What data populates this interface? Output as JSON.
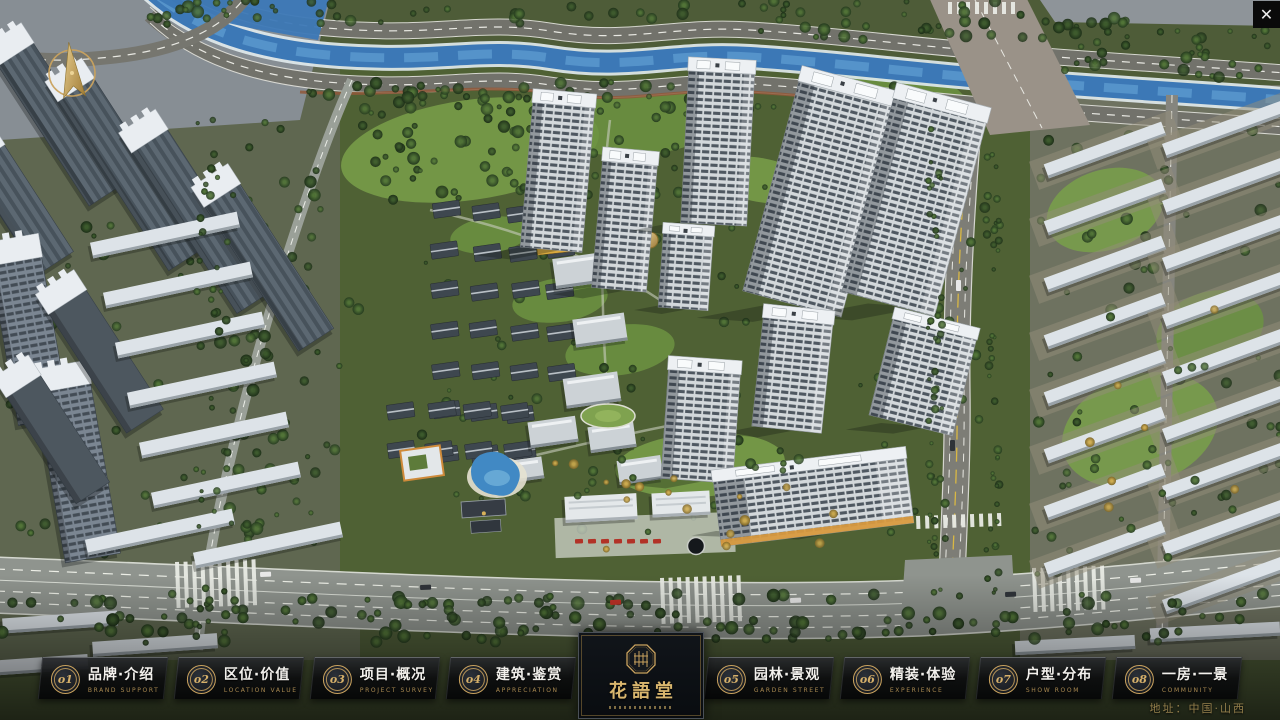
{
  "colors": {
    "accent_gold": "#C9A25E",
    "nav_title_text": "#F2F0EC",
    "nav_subtitle_text": "#A88850",
    "address_text": "#95804C",
    "nav_panel_bg": "#0B0D10"
  },
  "icons": {
    "close": "✕",
    "compass": "north-arrow",
    "logo_seal": "octagon-seal"
  },
  "nav": {
    "items": [
      {
        "num": "o1",
        "title": "品牌·介绍",
        "sub": "BRAND SUPPORT"
      },
      {
        "num": "o2",
        "title": "区位·价值",
        "sub": "LOCATION VALUE"
      },
      {
        "num": "o3",
        "title": "项目·概况",
        "sub": "PROJECT SURVEY"
      },
      {
        "num": "o4",
        "title": "建筑·鉴赏",
        "sub": "APPRECIATION"
      },
      {
        "num": "o5",
        "title": "园林·景观",
        "sub": "GARDEN STREET"
      },
      {
        "num": "o6",
        "title": "精装·体验",
        "sub": "EXPERIENCE"
      },
      {
        "num": "o7",
        "title": "户型·分布",
        "sub": "SHOW ROOM"
      },
      {
        "num": "o8",
        "title": "一房·一景",
        "sub": "COMMUNITY"
      }
    ]
  },
  "logo": {
    "title": "花語堂"
  },
  "footer": {
    "address": "地址：中国·山西"
  }
}
